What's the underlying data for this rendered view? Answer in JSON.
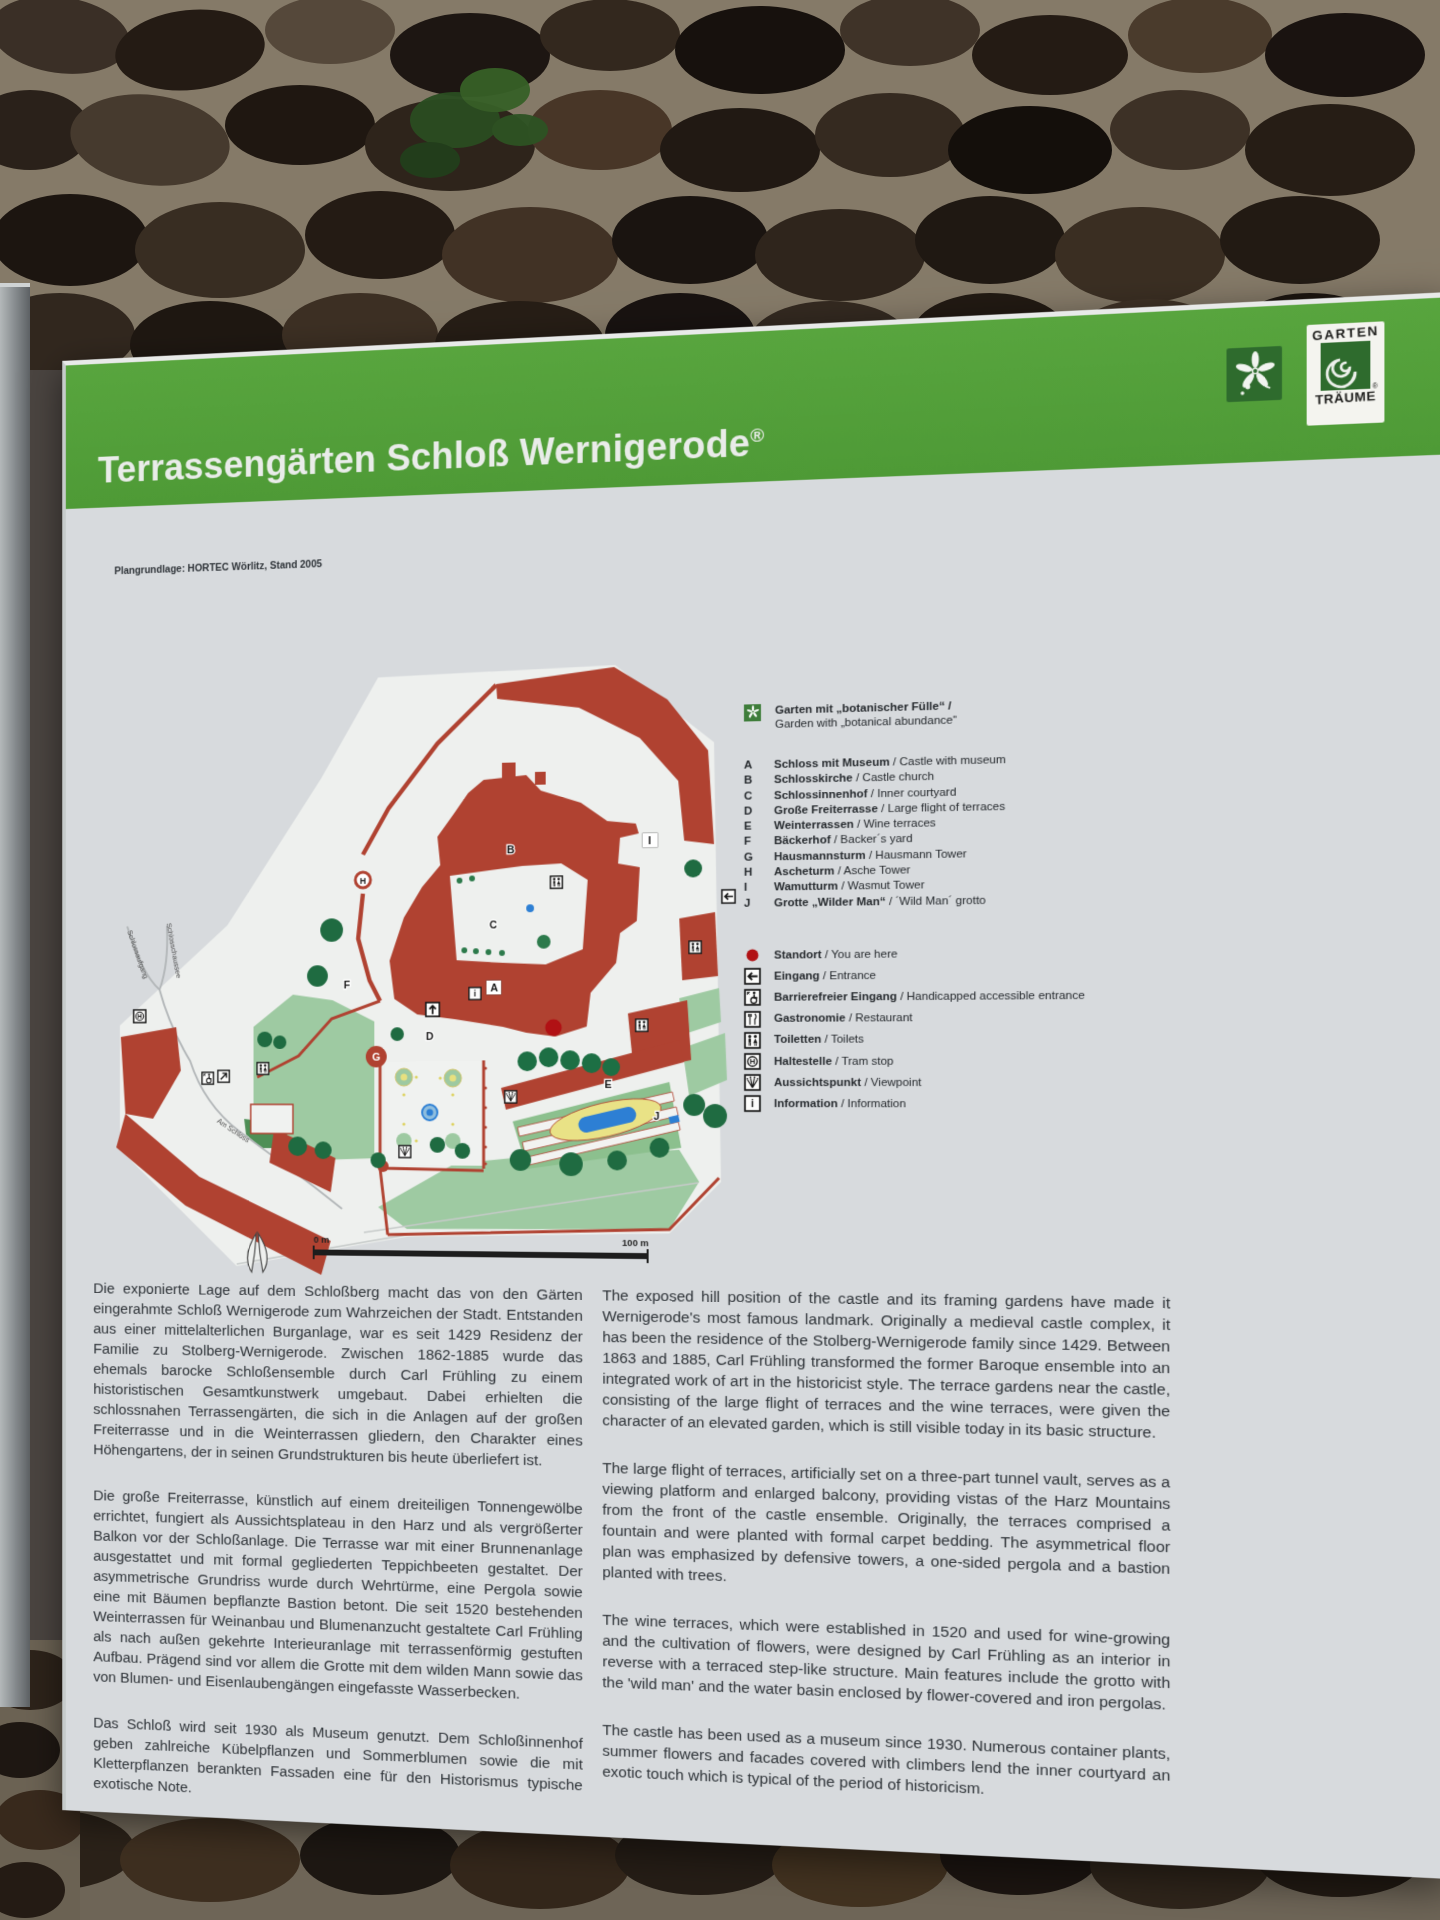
{
  "sign": {
    "title": "Terrassengärten Schloß Wernigerode",
    "reg": "®",
    "sep": " / ",
    "colors": {
      "header_green": "#55a13b",
      "map_red": "#b04231",
      "lawn_green": "#9ecaa2",
      "tree_green": "#1f6b41",
      "water_blue": "#2d7fd4",
      "bed_yellow": "#e9e286",
      "marker_red": "#b11114",
      "panel_gray": "#d7dadd"
    },
    "logos": {
      "gt1": "GARTEN",
      "gt2": "TRÄUME"
    },
    "map": {
      "credit": "Plangrundlage: HORTEC Wörlitz, Stand 2005",
      "scale_start": "0 m",
      "scale_end": "100 m",
      "streets": [
        "Schlossaufgang",
        "Schlosschaussee",
        "Am Schloss"
      ],
      "letters": [
        "A",
        "B",
        "C",
        "D",
        "E",
        "F",
        "G",
        "H",
        "I",
        "J"
      ]
    },
    "legend": {
      "garden_de": "Garten mit „botanischer Fülle“ /",
      "garden_en": "Garden with „botanical abundance“",
      "places": [
        {
          "k": "A",
          "de": "Schloss mit Museum",
          "en": "Castle with museum"
        },
        {
          "k": "B",
          "de": "Schlosskirche",
          "en": "Castle church"
        },
        {
          "k": "C",
          "de": "Schlossinnenhof",
          "en": "Inner courtyard"
        },
        {
          "k": "D",
          "de": "Große Freiterrasse",
          "en": "Large flight of terraces"
        },
        {
          "k": "E",
          "de": "Weinterrassen",
          "en": "Wine terraces"
        },
        {
          "k": "F",
          "de": "Bäckerhof",
          "en": "Backer´s yard"
        },
        {
          "k": "G",
          "de": "Hausmannsturm",
          "en": "Hausmann Tower"
        },
        {
          "k": "H",
          "de": "Ascheturm",
          "en": "Asche Tower"
        },
        {
          "k": "I",
          "de": "Wamutturm",
          "en": "Wasmut Tower"
        },
        {
          "k": "J",
          "de": "Grotte „Wilder Man“",
          "en": "´Wild Man´ grotto"
        }
      ],
      "symbols": [
        {
          "icon": "you-are-here",
          "de": "Standort",
          "en": "You are here"
        },
        {
          "icon": "entrance-arrow",
          "de": "Eingang",
          "en": "Entrance"
        },
        {
          "icon": "handicapped-entrance",
          "de": "Barrierefreier Eingang",
          "en": "Handicapped accessible entrance"
        },
        {
          "icon": "restaurant",
          "de": "Gastronomie",
          "en": "Restaurant"
        },
        {
          "icon": "toilets",
          "de": "Toiletten",
          "en": "Toilets"
        },
        {
          "icon": "tram-stop",
          "de": "Haltestelle",
          "en": "Tram stop"
        },
        {
          "icon": "viewpoint",
          "de": "Aussichtspunkt",
          "en": "Viewpoint"
        },
        {
          "icon": "information",
          "de": "Information",
          "en": "Information"
        }
      ]
    },
    "body_de": [
      "Die exponierte Lage auf dem Schloßberg macht das von den Gärten eingerahmte Schloß Wernigerode zum Wahrzeichen der Stadt. Entstanden aus einer mittelalterlichen Burganlage, war es seit 1429 Residenz der Familie zu Stolberg-Wernigerode. Zwischen 1862-1885 wurde das ehemals barocke Schloßensemble durch Carl Frühling zu einem historistischen Gesamtkunstwerk umgebaut. Dabei erhielten die schlossnahen Terrassengärten, die sich in die Anlagen auf der großen Freiterrasse und in die Weinterrassen gliedern, den Charakter eines Höhengartens, der in seinen Grundstrukturen bis heute überliefert ist.",
      "Die große Freiterrasse, künstlich auf einem dreiteiligen Tonnengewölbe errichtet, fungiert als Aussichtsplateau in den Harz und als vergrößerter Balkon vor der Schloßanlage. Die Terrasse war mit einer Brunnenanlage ausgestattet und mit formal gegliederten Teppichbeeten gestaltet. Der asymmetrische Grundriss wurde durch Wehrtürme, eine Pergola sowie eine mit Bäumen bepflanzte Bastion betont. Die seit 1520 bestehenden Weinterrassen für Weinanbau und Blumenanzucht gestaltete Carl Frühling als nach außen gekehrte Interieuranlage mit terrassenförmig gestuften Aufbau. Prägend sind vor allem die Grotte mit dem wilden Mann sowie das von Blumen- und Eisenlaubengängen eingefasste Wasserbecken.",
      "Das Schloß wird seit 1930 als Museum genutzt. Dem Schloßinnenhof geben zahlreiche Kübelpflanzen und Sommerblumen sowie die mit Kletterpflanzen berankten Fassaden eine für den Historismus typische exotische Note."
    ],
    "body_en": [
      "The exposed hill position of the castle and its framing gardens have made it Wernigerode's most famous landmark. Originally a medieval castle complex, it has been the residence of the Stolberg-Wernigerode family since 1429. Between 1863 and 1885, Carl Frühling transformed the former Baroque ensemble into an integrated work of art in the historicist style. The terrace gardens near the castle, consisting of the large flight of terraces and the wine terraces, were given the character of an elevated garden, which is still visible today in its basic structure.",
      "The large flight of terraces, artificially set on a three-part tunnel vault, serves as a viewing platform and enlarged balcony, providing vistas of the Harz Mountains from the front of the castle ensemble. Originally, the terraces comprised a fountain and were planted with formal carpet bedding. The asymmetrical floor plan was emphasized by defensive towers, a one-sided pergola and a bastion planted with trees.",
      "The wine terraces, which were established in 1520 and used for wine-growing and the cultivation of flowers, were designed by Carl Frühling as an interior in reverse with a terraced step-like structure. Main features include the grotto with the 'wild man' and the water basin enclosed by flower-covered and iron pergolas.",
      "The castle has been used as a museum since 1930. Numerous container plants, summer flowers and facades covered with climbers lend the inner courtyard an exotic touch which is typical of the period of historicism."
    ]
  }
}
